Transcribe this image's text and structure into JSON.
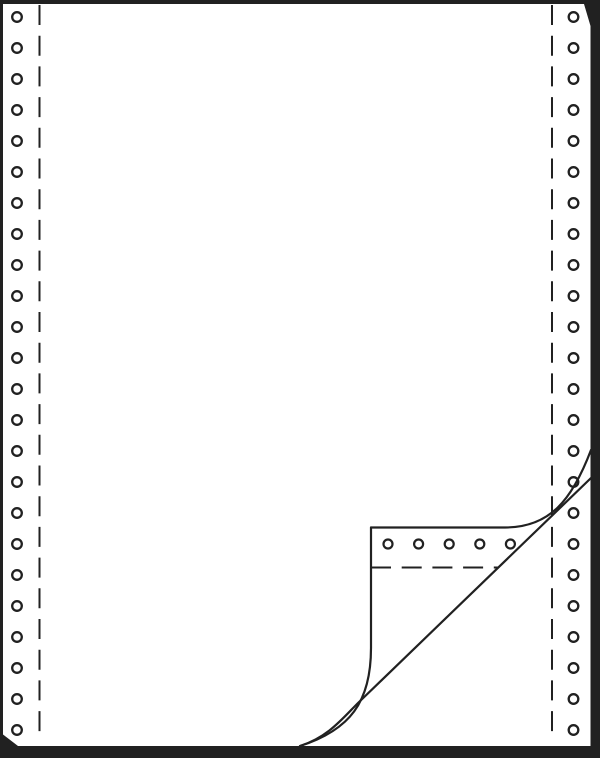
{
  "illustration": {
    "alt_text": "Blank continuous fanfold computer paper with sprocket-feed margins and a curled bottom-right corner revealing the next sheet",
    "canvas": {
      "width": 600,
      "height": 758
    },
    "colors": {
      "background": "#212121",
      "paper": "#ffffff",
      "line": "#212121"
    },
    "paper_outline_points": "3,4 584,4 590.5,26 590.5,746 18,746 3,734.5",
    "sprocket_columns": {
      "left_cx": 17,
      "right_cx": 573.5,
      "first_cy": 17,
      "pitch": 31,
      "count": 24,
      "hole_radius": 4.8,
      "ring_stroke": 2.3
    },
    "perforation_lines": {
      "left_x": 39.5,
      "right_x": 552,
      "y_top": 5,
      "y_bottom": 741,
      "stroke": 2,
      "dash": "20 10.7"
    },
    "curled_corner": {
      "curl_silhouette_path": "M 371 527.5 L 505 527.5 C 550 527.5 572 500 591 450",
      "flap_edge_path": "M 371 527.5 L 371 648 C 371 702 350 730 300 746",
      "fold_diagonal_path": "M 591 478 L 358 703 C 342 719 328 737 300 746",
      "line_stroke": 2.2,
      "flap_holes": {
        "cy": 544,
        "first_cx": 388,
        "pitch": 30.6,
        "count": 5,
        "hole_radius": 4.5,
        "ring_stroke": 2.2
      },
      "flap_perforation": {
        "y": 567.5,
        "x1": 371,
        "x2": 498,
        "stroke": 2,
        "dash": "20 10.7"
      }
    }
  }
}
